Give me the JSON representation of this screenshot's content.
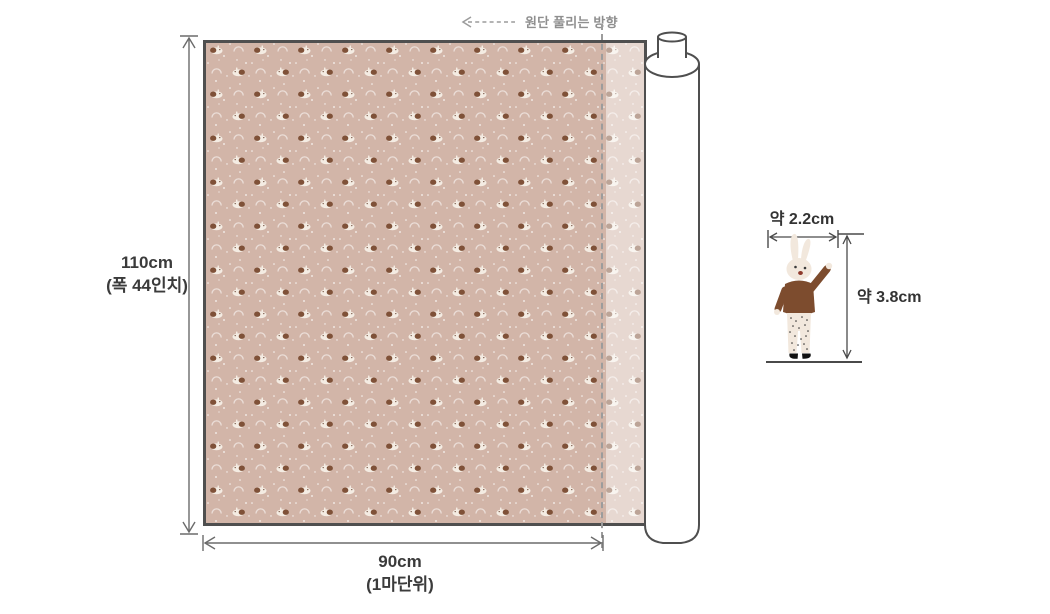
{
  "direction": {
    "label": "원단 풀리는 방향"
  },
  "dimensions": {
    "height": {
      "value": "110cm",
      "note": "(폭 44인치)"
    },
    "width": {
      "value": "90cm",
      "note": "(1마단위)"
    }
  },
  "motif": {
    "width": {
      "value": "약 2.2cm"
    },
    "height": {
      "value": "약 3.8cm"
    }
  },
  "icons": {
    "unroll_direction_arrow": "dashed-arrow-left-icon",
    "dimension_arrows": "double-headed-arrow-icon"
  },
  "colors": {
    "fabric_base": "#d2b5a8",
    "fabric_border": "#4f4f4f",
    "selvage_overlay": "rgba(255,255,255,0.48)",
    "dashed_line": "#9c9c9c",
    "dimension_line": "#6b6b6b",
    "dark_line": "#4a4a4a",
    "text_primary": "#3b3b3b",
    "text_muted": "#8f8f8f",
    "rabbit_body": "#f2e8dd",
    "rabbit_sweater": "#7d4c2e",
    "rabbit_mouth": "#8e3a2c",
    "roll_fill": "#ffffff"
  }
}
